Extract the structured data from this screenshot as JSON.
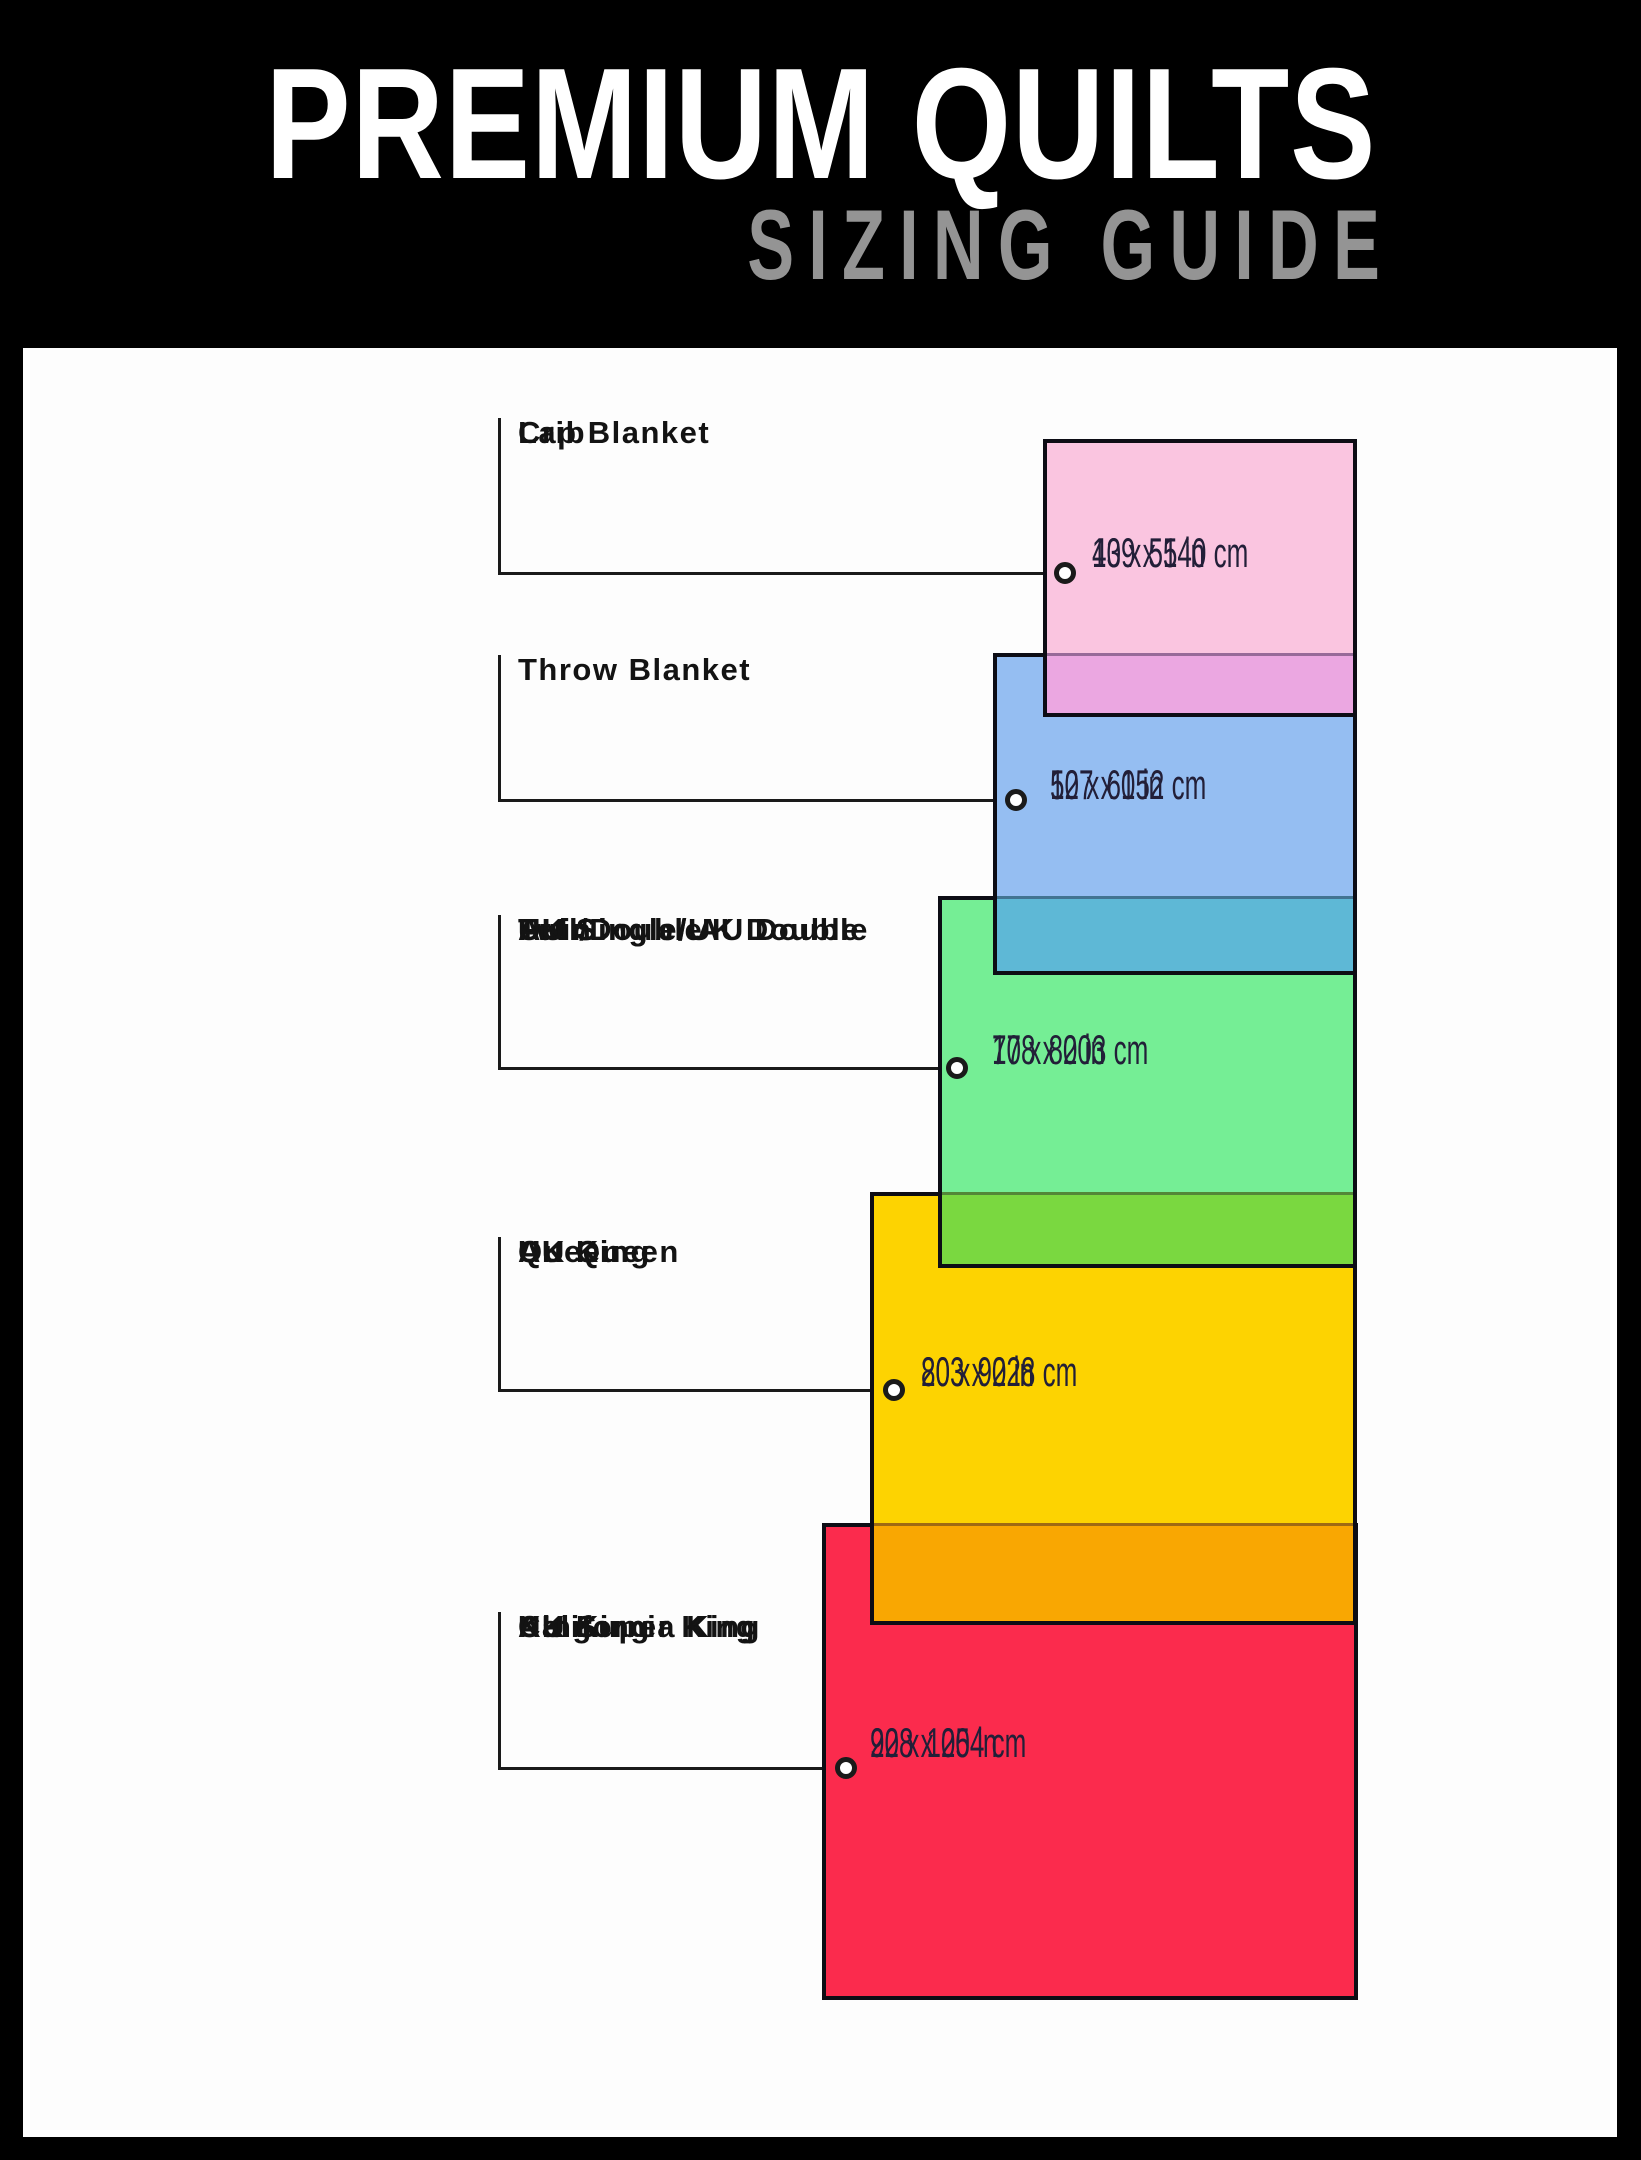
{
  "header": {
    "title": "PREMIUM QUILTS",
    "subtitle": "SIZING GUIDE"
  },
  "theme": {
    "bg": "#000000",
    "panel": "#fdfdfd",
    "title": "#ffffff",
    "subtitle": "#949494",
    "line": "#1a1a1a",
    "label": "#131313",
    "meas": "#221f38",
    "border": "#0d0d15",
    "band-edge": "rgba(25,15,45,0.4)",
    "ring-fill": "#ffffff"
  },
  "diagram": {
    "sizes": [
      {
        "name": "lap-blanket-crib",
        "labels": [
          "Lap Blanket",
          "Crib"
        ],
        "inches": "43 x 55 in",
        "cm": "109 x 140 cm",
        "fill": "#fac5e0",
        "overlap_fill": "#eba7e1",
        "rect": {
          "x": 1043,
          "y": 439,
          "w": 314,
          "h": 278
        },
        "band_top": 653,
        "tick": {
          "x": 498,
          "top": 418
        },
        "leader_y": 573,
        "ring_cx": 1065,
        "label_pos": {
          "x": 518,
          "y": 415
        },
        "meas_pos": {
          "x": 1092,
          "y": 531
        }
      },
      {
        "name": "throw-blanket",
        "labels": [
          "Throw Blanket"
        ],
        "inches": "50 x 60 in",
        "cm": "127 x 152 cm",
        "fill": "#95bef2",
        "overlap_fill": "#5eb8d6",
        "rect": {
          "x": 993,
          "y": 653,
          "w": 364,
          "h": 322
        },
        "band_top": 896,
        "tick": {
          "x": 498,
          "top": 655
        },
        "leader_y": 800,
        "ring_cx": 1016,
        "label_pos": {
          "x": 518,
          "y": 652
        },
        "meas_pos": {
          "x": 1050,
          "y": 763
        }
      },
      {
        "name": "twin-full-double",
        "labels": [
          "Twin",
          "Full/Double",
          "UK Single/UK Double",
          "AU Single/ AU Double"
        ],
        "inches": "70 x 80 in",
        "cm": "178 x 203 cm",
        "fill": "#75ee95",
        "overlap_fill": "#7ad840",
        "rect": {
          "x": 938,
          "y": 896,
          "w": 419,
          "h": 372
        },
        "band_top": 1192,
        "tick": {
          "x": 498,
          "top": 915
        },
        "leader_y": 1068,
        "ring_cx": 957,
        "label_pos": {
          "x": 518,
          "y": 912
        },
        "meas_pos": {
          "x": 992,
          "y": 1028
        }
      },
      {
        "name": "queen-uk-king-au-queen",
        "labels": [
          "Queen",
          "UK King",
          "AU Queen"
        ],
        "inches": "80 x 90 in",
        "cm": "203 x 228 cm",
        "fill": "#fdd301",
        "overlap_fill": "#f9a702",
        "rect": {
          "x": 870,
          "y": 1192,
          "w": 487,
          "h": 433
        },
        "band_top": 1523,
        "tick": {
          "x": 498,
          "top": 1237
        },
        "leader_y": 1390,
        "ring_cx": 894,
        "label_pos": {
          "x": 518,
          "y": 1234
        },
        "meas_pos": {
          "x": 921,
          "y": 1350
        }
      },
      {
        "name": "king-california-king",
        "labels": [
          "King",
          "California King",
          "UK Super King",
          "AU King"
        ],
        "inches": "90 x 100 in",
        "cm": "228 x 254 cm",
        "fill": "#fb2b4d",
        "overlap_fill": null,
        "rect": {
          "x": 822,
          "y": 1523,
          "w": 536,
          "h": 477
        },
        "band_top": null,
        "tick": {
          "x": 498,
          "top": 1612
        },
        "leader_y": 1768,
        "ring_cx": 846,
        "label_pos": {
          "x": 518,
          "y": 1609
        },
        "meas_pos": {
          "x": 870,
          "y": 1721
        }
      }
    ]
  }
}
